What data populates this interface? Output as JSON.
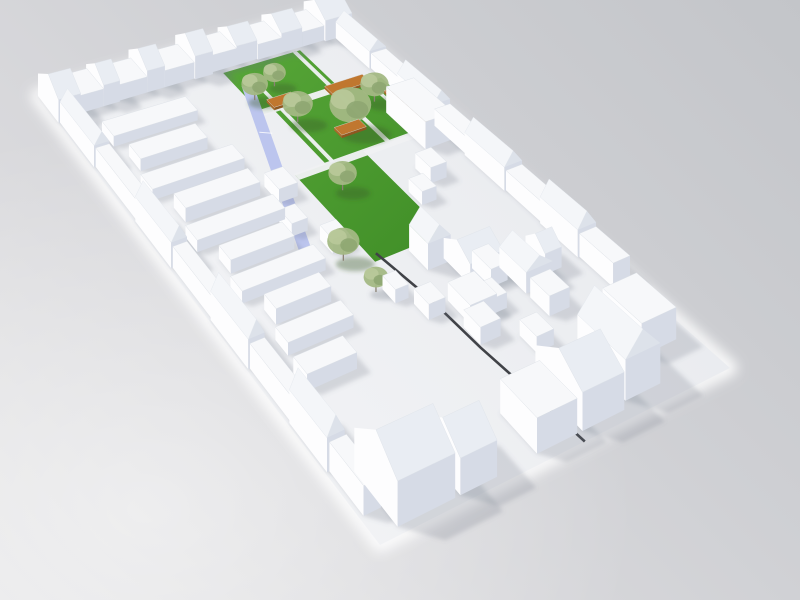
{
  "meta": {
    "description": "3D architectural massing model render of an urban block: white low-poly buildings around a central green courtyard park with trees, wooden benches, a lavender ramp and a dark diagonal footpath, on a neutral gray studio background",
    "view": "aerial axonometric, block rotated diagonally, sunlight from lower-left"
  },
  "palette": {
    "wall_lit": "#fdfdfe",
    "wall_shade": "#d6dbe6",
    "roof_flat": "#f7f8fa",
    "roof_slope_front": "#e9edf3",
    "roof_slope_lit": "#f4f6f9",
    "gable_shade": "#dde2ea",
    "ground_light": "#f4f5f7",
    "ground_dark": "#e8eaee",
    "lawn_light": "#55a436",
    "lawn_dark": "#3e8c26",
    "path": "#eff1f3",
    "ribbon": "#bcc5ee",
    "dark_path": "#404247",
    "bench_top": "#c0772f",
    "bench_front": "#8f5720",
    "bench_side": "#a96828",
    "canopy": "#a3b884",
    "canopy_light": "#b9c99a",
    "canopy_dark": "#8da671",
    "trunk": "#8b8274",
    "shadow": "rgba(106,112,128,0.22)",
    "tree_shadow_grass": "rgba(55,90,42,0.38)",
    "tree_shadow_paving": "rgba(100,106,122,0.28)",
    "halo": "#ffffff"
  },
  "scene": {
    "quad": {
      "W": [
        38,
        96
      ],
      "N": [
        330,
        14
      ],
      "S": [
        380,
        545
      ],
      "E": [
        730,
        368
      ]
    },
    "height_scale": {
      "k": 2.5,
      "au": -0.22,
      "av": 0.55
    },
    "gable_ratio": 0.55,
    "shadow_shift": [
      0.85,
      0.24
    ],
    "lawns": [
      [
        0.56,
        0.058,
        0.26,
        0.105
      ],
      [
        0.6,
        0.16,
        0.37,
        0.14
      ],
      [
        0.5,
        0.3,
        0.22,
        0.215
      ]
    ],
    "paths": [
      [
        0.54,
        0.152,
        0.44,
        0.014
      ],
      [
        0.5,
        0.296,
        0.47,
        0.015
      ],
      [
        0.795,
        0.058,
        0.014,
        0.245
      ],
      [
        0.615,
        0.09,
        0.013,
        0.21
      ],
      [
        0.9,
        0.16,
        0.012,
        0.14
      ]
    ],
    "ribbon": [
      [
        0.575,
        0.095
      ],
      [
        0.605,
        0.105
      ],
      [
        0.345,
        0.505
      ],
      [
        0.315,
        0.495
      ]
    ],
    "dark_path": [
      [
        0.52,
        0.5
      ],
      [
        0.545,
        0.62
      ],
      [
        0.555,
        0.75
      ],
      [
        0.575,
        0.9
      ],
      [
        0.585,
        1.0
      ]
    ],
    "benches": [
      [
        0.6,
        0.142,
        0.08,
        0.02
      ],
      [
        0.78,
        0.152,
        0.125,
        0.02
      ],
      [
        0.915,
        0.2,
        0.03,
        0.13
      ],
      [
        0.7,
        0.24,
        0.08,
        0.02
      ]
    ],
    "trees": [
      [
        0.575,
        0.13,
        14,
        1
      ],
      [
        0.63,
        0.2,
        16,
        1
      ],
      [
        0.87,
        0.21,
        15,
        1
      ],
      [
        0.74,
        0.25,
        22,
        1
      ],
      [
        0.66,
        0.115,
        12,
        1
      ],
      [
        0.58,
        0.36,
        15,
        1
      ],
      [
        0.43,
        0.49,
        17,
        1
      ],
      [
        0.44,
        0.57,
        13,
        0
      ]
    ],
    "buildings": [
      [
        0.0,
        0.0,
        0.075,
        0.06,
        9.0,
        "gu"
      ],
      [
        0.075,
        0.006,
        0.085,
        0.048,
        7.0,
        "f"
      ],
      [
        0.16,
        0.004,
        0.055,
        0.05,
        8.5,
        "gu"
      ],
      [
        0.215,
        0.006,
        0.095,
        0.046,
        6.5,
        "f"
      ],
      [
        0.31,
        0.0,
        0.06,
        0.052,
        9.0,
        "gu"
      ],
      [
        0.37,
        0.006,
        0.1,
        0.046,
        7.0,
        "f"
      ],
      [
        0.47,
        0.0,
        0.06,
        0.054,
        10.0,
        "gu"
      ],
      [
        0.53,
        0.006,
        0.085,
        0.044,
        7.5,
        "f"
      ],
      [
        0.615,
        0.0,
        0.07,
        0.05,
        8.5,
        "gu"
      ],
      [
        0.685,
        0.006,
        0.08,
        0.046,
        7.0,
        "f"
      ],
      [
        0.765,
        0.0,
        0.07,
        0.052,
        9.0,
        "gu"
      ],
      [
        0.835,
        0.006,
        0.075,
        0.046,
        7.0,
        "f"
      ],
      [
        0.91,
        0.0,
        0.09,
        0.055,
        10.0,
        "gu"
      ],
      [
        0.945,
        0.055,
        0.055,
        0.085,
        8.0,
        "gv"
      ],
      [
        0.95,
        0.14,
        0.05,
        0.07,
        7.0,
        "f"
      ],
      [
        0.945,
        0.21,
        0.055,
        0.09,
        9.0,
        "gv"
      ],
      [
        0.95,
        0.3,
        0.05,
        0.08,
        7.0,
        "f"
      ],
      [
        0.945,
        0.38,
        0.055,
        0.1,
        9.0,
        "gv"
      ],
      [
        0.95,
        0.48,
        0.05,
        0.09,
        7.5,
        "f"
      ],
      [
        0.945,
        0.57,
        0.055,
        0.095,
        9.5,
        "gv"
      ],
      [
        0.95,
        0.665,
        0.05,
        0.085,
        8.0,
        "f"
      ],
      [
        0.005,
        0.06,
        0.05,
        0.1,
        8.0,
        "gv"
      ],
      [
        0.01,
        0.16,
        0.045,
        0.12,
        7.0,
        "f"
      ],
      [
        0.005,
        0.28,
        0.05,
        0.105,
        8.5,
        "gv"
      ],
      [
        0.01,
        0.385,
        0.045,
        0.115,
        7.0,
        "f"
      ],
      [
        0.005,
        0.5,
        0.05,
        0.11,
        9.0,
        "gv"
      ],
      [
        0.01,
        0.61,
        0.045,
        0.12,
        7.5,
        "f"
      ],
      [
        0.005,
        0.73,
        0.052,
        0.11,
        9.5,
        "gv"
      ],
      [
        0.012,
        0.84,
        0.05,
        0.1,
        8.0,
        "f"
      ],
      [
        0.065,
        0.86,
        0.165,
        0.125,
        12.0,
        "gu"
      ],
      [
        0.245,
        0.885,
        0.105,
        0.1,
        10.0,
        "gu"
      ],
      [
        0.47,
        0.88,
        0.115,
        0.1,
        10.0,
        "f"
      ],
      [
        0.6,
        0.855,
        0.12,
        0.125,
        11.0,
        "gu"
      ],
      [
        0.74,
        0.84,
        0.1,
        0.125,
        12.0,
        "gv"
      ],
      [
        0.86,
        0.8,
        0.1,
        0.1,
        10.0,
        "f"
      ],
      [
        0.1,
        0.1,
        0.28,
        0.034,
        4.0,
        "f"
      ],
      [
        0.12,
        0.16,
        0.22,
        0.034,
        4.5,
        "f"
      ],
      [
        0.09,
        0.22,
        0.3,
        0.034,
        4.0,
        "f"
      ],
      [
        0.13,
        0.28,
        0.24,
        0.034,
        5.0,
        "f"
      ],
      [
        0.1,
        0.34,
        0.28,
        0.034,
        4.0,
        "f"
      ],
      [
        0.14,
        0.4,
        0.2,
        0.034,
        4.5,
        "f"
      ],
      [
        0.11,
        0.46,
        0.26,
        0.034,
        4.0,
        "f"
      ],
      [
        0.15,
        0.52,
        0.17,
        0.034,
        5.0,
        "f"
      ],
      [
        0.12,
        0.58,
        0.2,
        0.036,
        4.0,
        "f"
      ],
      [
        0.1,
        0.65,
        0.15,
        0.04,
        5.0,
        "f"
      ],
      [
        0.87,
        0.24,
        0.09,
        0.1,
        11.0,
        "f"
      ],
      [
        0.4,
        0.3,
        0.06,
        0.04,
        5.0,
        "f"
      ],
      [
        0.36,
        0.375,
        0.05,
        0.035,
        4.5,
        "f"
      ],
      [
        0.42,
        0.435,
        0.05,
        0.035,
        5.0,
        "f"
      ],
      [
        0.8,
        0.37,
        0.05,
        0.04,
        6.0,
        "f"
      ],
      [
        0.73,
        0.41,
        0.045,
        0.035,
        5.0,
        "f"
      ],
      [
        0.6,
        0.52,
        0.07,
        0.05,
        9.0,
        "gv"
      ],
      [
        0.66,
        0.56,
        0.1,
        0.07,
        7.0,
        "gu"
      ],
      [
        0.58,
        0.64,
        0.08,
        0.06,
        6.0,
        "f"
      ],
      [
        0.76,
        0.62,
        0.08,
        0.07,
        7.0,
        "gv"
      ],
      [
        0.5,
        0.62,
        0.05,
        0.04,
        5.0,
        "f"
      ],
      [
        0.56,
        0.7,
        0.06,
        0.045,
        5.5,
        "f"
      ],
      [
        0.64,
        0.66,
        0.05,
        0.04,
        5.0,
        "f"
      ],
      [
        0.7,
        0.6,
        0.05,
        0.05,
        6.0,
        "f"
      ],
      [
        0.76,
        0.7,
        0.06,
        0.05,
        6.5,
        "f"
      ],
      [
        0.66,
        0.76,
        0.05,
        0.045,
        5.0,
        "f"
      ],
      [
        0.46,
        0.57,
        0.04,
        0.035,
        4.5,
        "f"
      ],
      [
        0.84,
        0.62,
        0.05,
        0.05,
        7.0,
        "gu"
      ]
    ]
  }
}
